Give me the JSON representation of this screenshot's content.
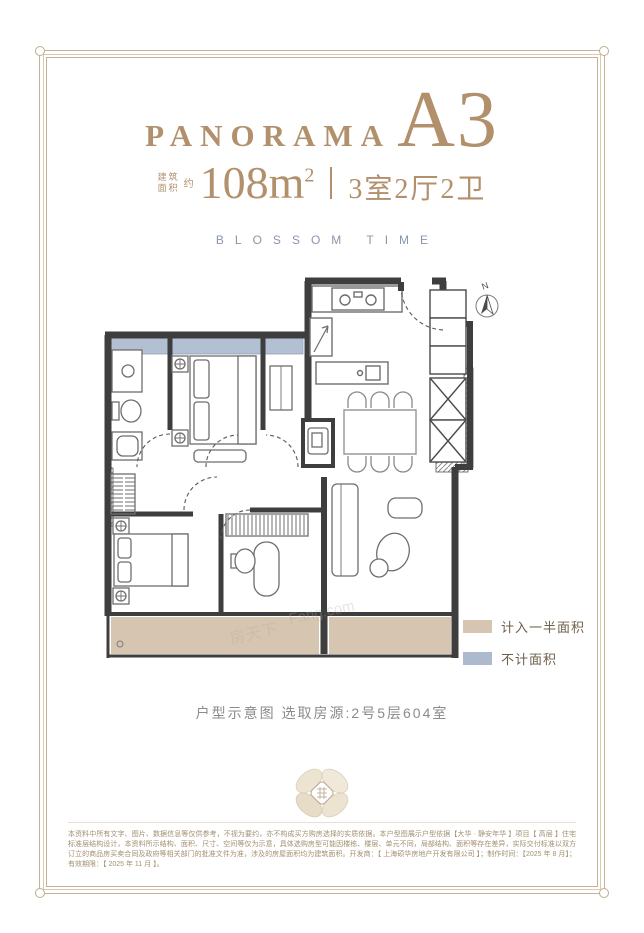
{
  "header": {
    "brand": "PANORAMA",
    "unit": "A3",
    "area_label_line1": "建筑",
    "area_label_line2": "面积",
    "area_approx": "约",
    "area_value": "108m",
    "area_sup": "2",
    "layout": "3室2厅2卫",
    "subtitle": "BLOSSOM TIME"
  },
  "floorplan": {
    "compass_label": "N",
    "watermark_cn": "房天下",
    "watermark_en": "Fang.com"
  },
  "legend": {
    "items": [
      {
        "label": "计入一半面积",
        "color": "#d6c5b0"
      },
      {
        "label": "不计面积",
        "color": "#adbacd"
      }
    ]
  },
  "caption": "户型示意图 选取房源:2号5层604室",
  "disclaimer": "本资料中所有文字、图片、数据信息等仅供参考，不视为要约，亦不构成买方购房选择的实质依据。本户型图展示户型依据【大华 · 静安年华 】项目【 高层 】住宅标准层结构设计，本资料所示结构、面积、尺寸、空间等仅为示意，具体选购房型可能因楼栋、楼层、单元不同，局部结构、面积等存在差异，实际交付标准以双方订立的商品房买卖合同及政府等相关部门的批准文件为准，涉及的房屋面积均为建筑面积。开发商：【 上海硕华房地产开发有限公司 】；制作时间：【2025 年 8 月】；有效期限：【 2025 年 11 月 】。",
  "colors": {
    "gold": "#b2906b",
    "frame": "#c6b295",
    "blue_gray": "#8896ac",
    "wall": "#3e3e3e"
  }
}
